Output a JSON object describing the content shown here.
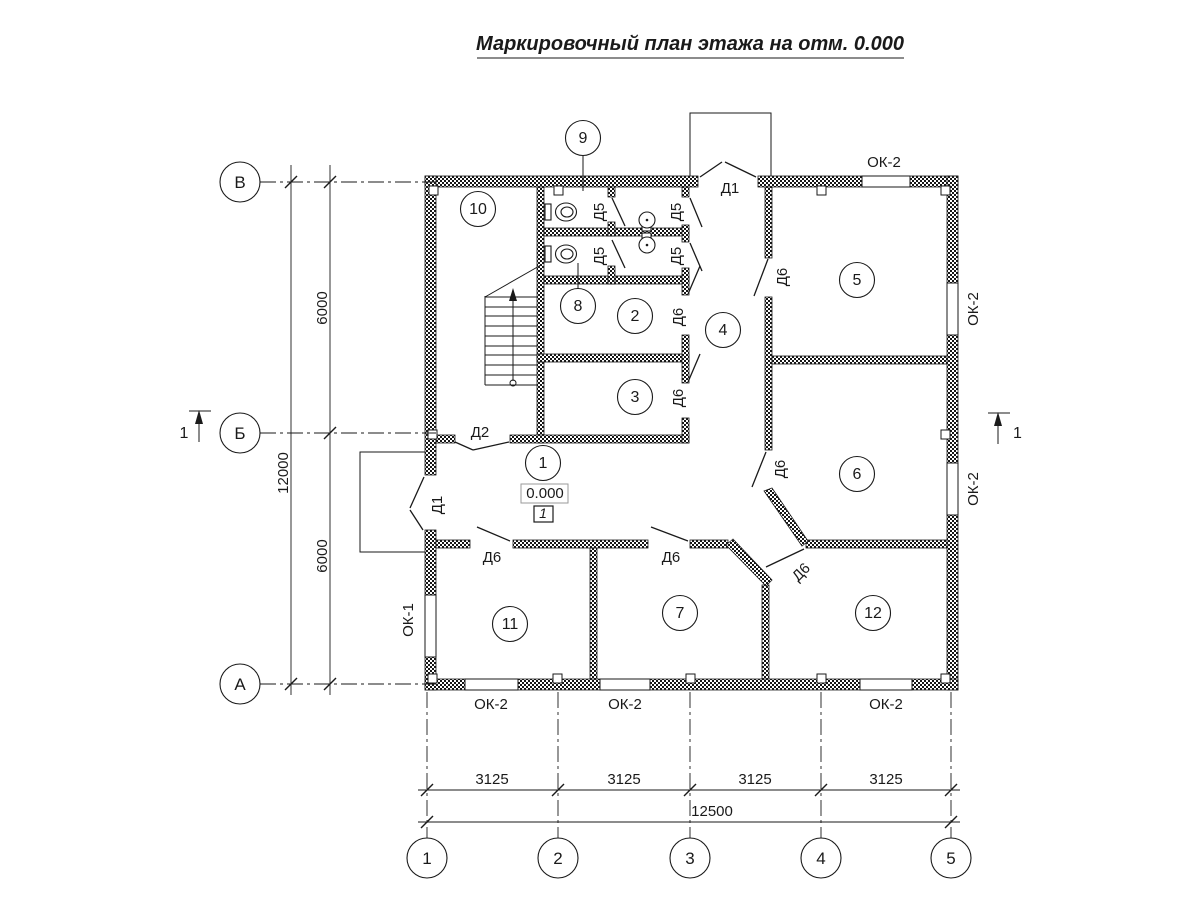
{
  "title": "Маркировочный план этажа на отм. 0.000",
  "row_axes": [
    "В",
    "Б",
    "А"
  ],
  "col_axes": [
    "1",
    "2",
    "3",
    "4",
    "5"
  ],
  "dims": {
    "total_height": "12000",
    "height_bays": [
      "6000",
      "6000"
    ],
    "bottom_bays": [
      "3125",
      "3125",
      "3125",
      "3125"
    ],
    "total_width": "12500"
  },
  "rooms": {
    "r1": "1",
    "r2": "2",
    "r3": "3",
    "r4": "4",
    "r5": "5",
    "r6": "6",
    "r7": "7",
    "r8": "8",
    "r9": "9",
    "r10": "10",
    "r11": "11",
    "r12": "12"
  },
  "elevation": {
    "value": "0.000",
    "floor_mark": "1"
  },
  "doors": {
    "d1": "Д1",
    "d2": "Д2",
    "d5": "Д5",
    "d6": "Д6"
  },
  "windows": {
    "ok1": "ОК-1",
    "ok2": "ОК-2"
  },
  "section_mark": "1"
}
